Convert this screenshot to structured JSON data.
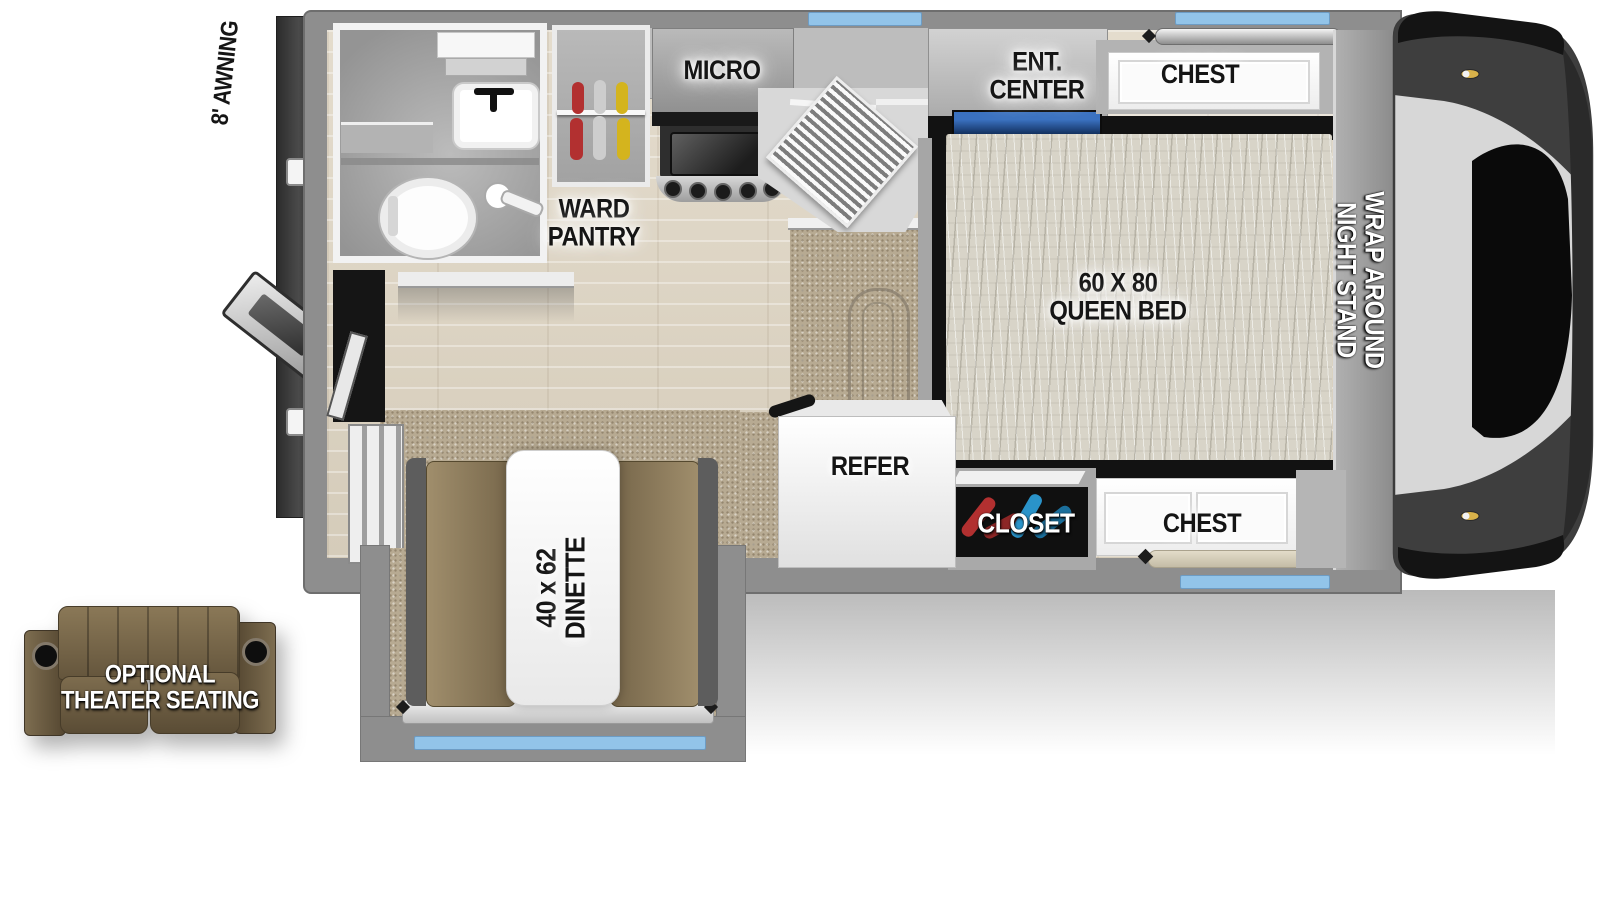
{
  "diagram": {
    "type": "rv-truck-camper-floorplan",
    "labels": {
      "awning": "8' AWNING",
      "micro": "MICRO",
      "ward_pantry": "WARD\nPANTRY",
      "ent_center": "ENT.\nCENTER",
      "chest_top": "CHEST",
      "queen_bed": "60 X 80\nQUEEN BED",
      "night_stand": "WRAP AROUND NIGHT STAND",
      "refer": "REFER",
      "closet": "CLOSET",
      "chest_bottom": "CHEST",
      "dinette": "40 x 62\nDINETTE",
      "theater_seating": "OPTIONAL\nTHEATER SEATING"
    }
  },
  "colors": {
    "wall": "#8e8e8e",
    "wall_dark": "#6e6e6e",
    "interior_wood": "#ddd4c4",
    "carpet": "#b7aa92",
    "mattress": "#d8d4c8",
    "window_blue": "#92c4e9",
    "bench_brown": "#8d7c5e",
    "sofa_brown": "#6e5f45",
    "table_white": "#f7f7f7",
    "cabinet_white": "#f5f5f5",
    "closet_black": "#101010",
    "tv_navy": "#1c4583",
    "hanger_red": "#b23030",
    "hanger_yellow": "#d4b41e",
    "hanger_blue": "#2a93c9",
    "label_black": "#151515",
    "label_white": "#ffffff"
  }
}
